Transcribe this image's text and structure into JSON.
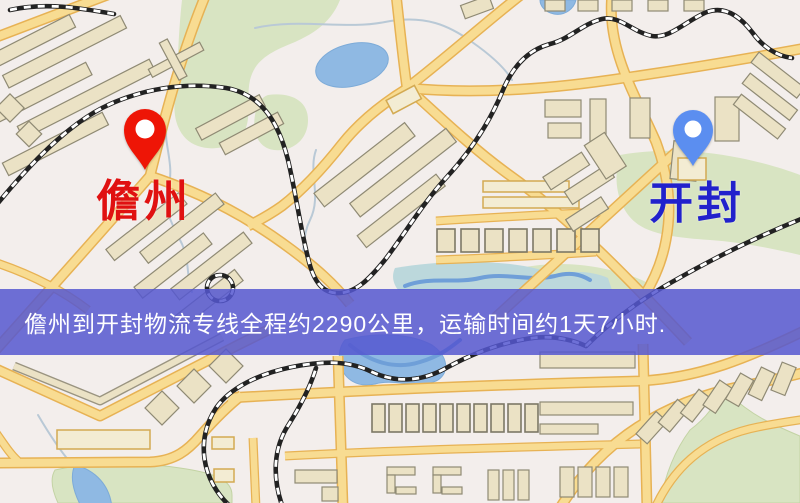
{
  "map": {
    "origin_marker": {
      "label": "儋州"
    },
    "destination_marker": {
      "label": "开封"
    }
  },
  "banner": {
    "text": "儋州到开封物流专线全程约2290公里，运输时间约1天7小时."
  },
  "icons": {
    "origin_pin": "red-map-pin-icon",
    "destination_pin": "blue-map-pin-icon"
  },
  "colors": {
    "map_bg": "#f3eeec",
    "park": "#d8e4c2",
    "water": "#8fb9e3",
    "water_deep": "#6f9fd8",
    "water_shallow": "#bcd8dc",
    "stream": "#b9c9d6",
    "road_casing": "#e7b254",
    "road_fill": "#f8dc92",
    "building_fill": "#ebe2c5",
    "building_stroke": "#8f8a74",
    "building_alt_fill": "#f3ecd3",
    "building_alt_stroke": "#d3aa52",
    "railway_dark": "#222222",
    "railway_light": "#ffffff",
    "banner_bg": "#5557d0",
    "banner_text": "#ffffff",
    "origin_pin": "#ee1506",
    "origin_label": "#e01111",
    "destination_pin": "#5b8ef0",
    "destination_label": "#2121cc"
  }
}
